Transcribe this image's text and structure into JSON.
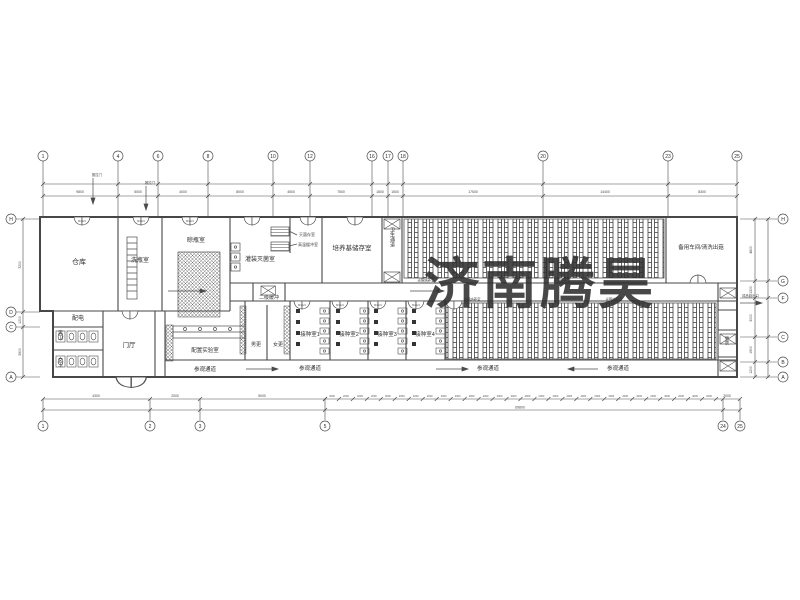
{
  "colors": {
    "line": "#4b4b4b",
    "watermark": "#e5383d"
  },
  "watermark": {
    "text": "济南腾昊"
  },
  "rooms": {
    "warehouse": "仓库",
    "bottle_wash": "洗瓶室",
    "bottle_airing": "晾瓶室",
    "filling_sterilization": "灌装灭菌室",
    "sterilized_storage": "灭菌存室",
    "high_temp_buffer": "高温缓冲室",
    "medium_storage": "培养基储存室",
    "sanitary_passage": "卫生通道",
    "light_culture": "光照培养室",
    "spare_workshop": "备用车间/清洗出菇",
    "secondary_buffer": "二级缓冲",
    "inoculation_1": "接种室1",
    "inoculation_2": "接种室2",
    "inoculation_3": "接种室3",
    "inoculation_4": "接种室4",
    "men_changing": "男更",
    "women_changing": "女更",
    "power_room": "配电",
    "men_wc": "男卫",
    "women_wc": "女卫",
    "lobby": "门厅",
    "prep_lab": "配置实验室",
    "changing": "更衣"
  },
  "labels": {
    "visit_passage": "参观通道",
    "product_exit": "成品菇出口",
    "sliding_door": "推拉门",
    "door_tag": "M1521"
  },
  "grid": {
    "top": [
      {
        "x": 43,
        "t": "1"
      },
      {
        "x": 118,
        "t": "4"
      },
      {
        "x": 158,
        "t": "6"
      },
      {
        "x": 208,
        "t": "8"
      },
      {
        "x": 273,
        "t": "10"
      },
      {
        "x": 310,
        "t": "12"
      },
      {
        "x": 372,
        "t": "16"
      },
      {
        "x": 388,
        "t": "17"
      },
      {
        "x": 403,
        "t": "18"
      },
      {
        "x": 543,
        "t": "20"
      },
      {
        "x": 668,
        "t": "23"
      },
      {
        "x": 737,
        "t": "25"
      }
    ],
    "bottom": [
      {
        "x": 43,
        "t": "1"
      },
      {
        "x": 150,
        "t": "2"
      },
      {
        "x": 200,
        "t": "3"
      },
      {
        "x": 325,
        "t": "5"
      },
      {
        "x": 723,
        "t": "24"
      },
      {
        "x": 740,
        "t": "25"
      }
    ],
    "left": [
      {
        "y": 219,
        "t": "H"
      },
      {
        "y": 312,
        "t": "D"
      },
      {
        "y": 327,
        "t": "C"
      },
      {
        "y": 377,
        "t": "A"
      }
    ],
    "right": [
      {
        "y": 219,
        "t": "H"
      },
      {
        "y": 281,
        "t": "G"
      },
      {
        "y": 298,
        "t": "F"
      },
      {
        "y": 337,
        "t": "C"
      },
      {
        "y": 362,
        "t": "B"
      },
      {
        "y": 377,
        "t": "A"
      }
    ]
  },
  "dims": {
    "top": [
      {
        "x": 80,
        "t": "9800"
      },
      {
        "x": 138,
        "t": "5000"
      },
      {
        "x": 183,
        "t": "4000"
      },
      {
        "x": 240,
        "t": "8000"
      },
      {
        "x": 291,
        "t": "4500"
      },
      {
        "x": 341,
        "t": "7500"
      },
      {
        "x": 380,
        "t": "1800"
      },
      {
        "x": 395,
        "t": "1500"
      },
      {
        "x": 473,
        "t": "17500"
      },
      {
        "x": 605,
        "t": "14400"
      },
      {
        "x": 702,
        "t": "8300"
      }
    ],
    "left": [
      {
        "y": 265,
        "t": "7200"
      },
      {
        "y": 320,
        "t": "1200"
      },
      {
        "y": 352,
        "t": "3900"
      }
    ],
    "right": [
      {
        "y": 250,
        "t": "4800"
      },
      {
        "y": 290,
        "t": "1300"
      },
      {
        "y": 318,
        "t": "3000"
      },
      {
        "y": 350,
        "t": "1900"
      },
      {
        "y": 370,
        "t": "1200"
      }
    ],
    "bottom": [
      {
        "x": 96,
        "t": "4300"
      },
      {
        "x": 175,
        "t": "2000"
      },
      {
        "x": 262,
        "t": "5000"
      },
      {
        "x": 727,
        "t": "2000"
      }
    ],
    "bottom_total": {
      "x": 520,
      "t": "69800"
    },
    "chain": {
      "x0": 325,
      "x1": 716,
      "n": 28,
      "labels": [
        "4000",
        "2000"
      ]
    }
  }
}
